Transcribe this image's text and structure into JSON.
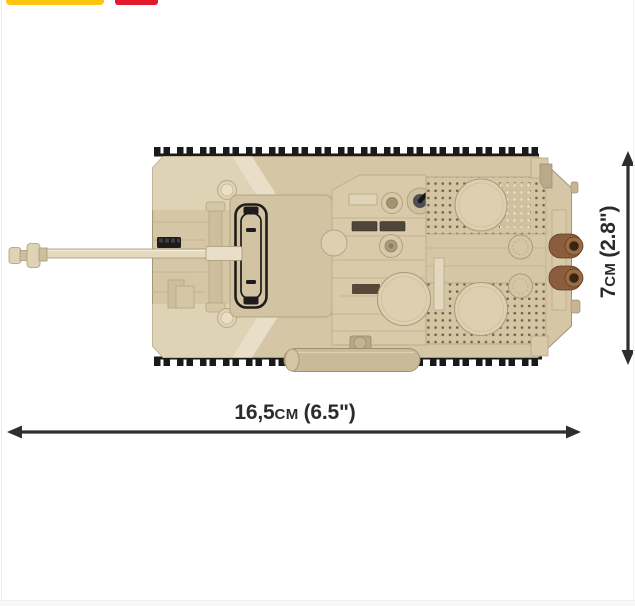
{
  "window": {
    "width": 635,
    "height": 606
  },
  "badges": {
    "yellow_badge_color": "#fdc60c",
    "red_badge_color": "#e31b2d"
  },
  "product_image": {
    "subject": "Brick-built tank model, top view, tan with black tracks"
  },
  "dimensions": {
    "width": {
      "value": "16,5",
      "unit": "CM",
      "imperial": "(6.5\")"
    },
    "height": {
      "value": "7",
      "unit": "CM",
      "imperial": "(2.8\")"
    }
  },
  "colors": {
    "page_bg": "#ffffff",
    "frame_line": "#ededed",
    "frame_strip": "#f7f7f7",
    "badge_yellow": "#fdc60c",
    "badge_red": "#e31b2d",
    "arrow": "#2e2e2e",
    "label_text": "#2b2b2b",
    "tank_base": "#d5c7a6",
    "tank_light": "#dfd3b6",
    "tank_lighter": "#e9dfc8",
    "tank_mid": "#cdbe9d",
    "tank_dark": "#b5a584",
    "tank_outline": "#a5967a",
    "track_black": "#1a1a1a",
    "detail_black": "#1e1c1a",
    "seam": "#c3b392",
    "exhaust_brown": "#8a5d3c",
    "exhaust_dark": "#3a2414",
    "grille_dot": "#6f6352"
  }
}
